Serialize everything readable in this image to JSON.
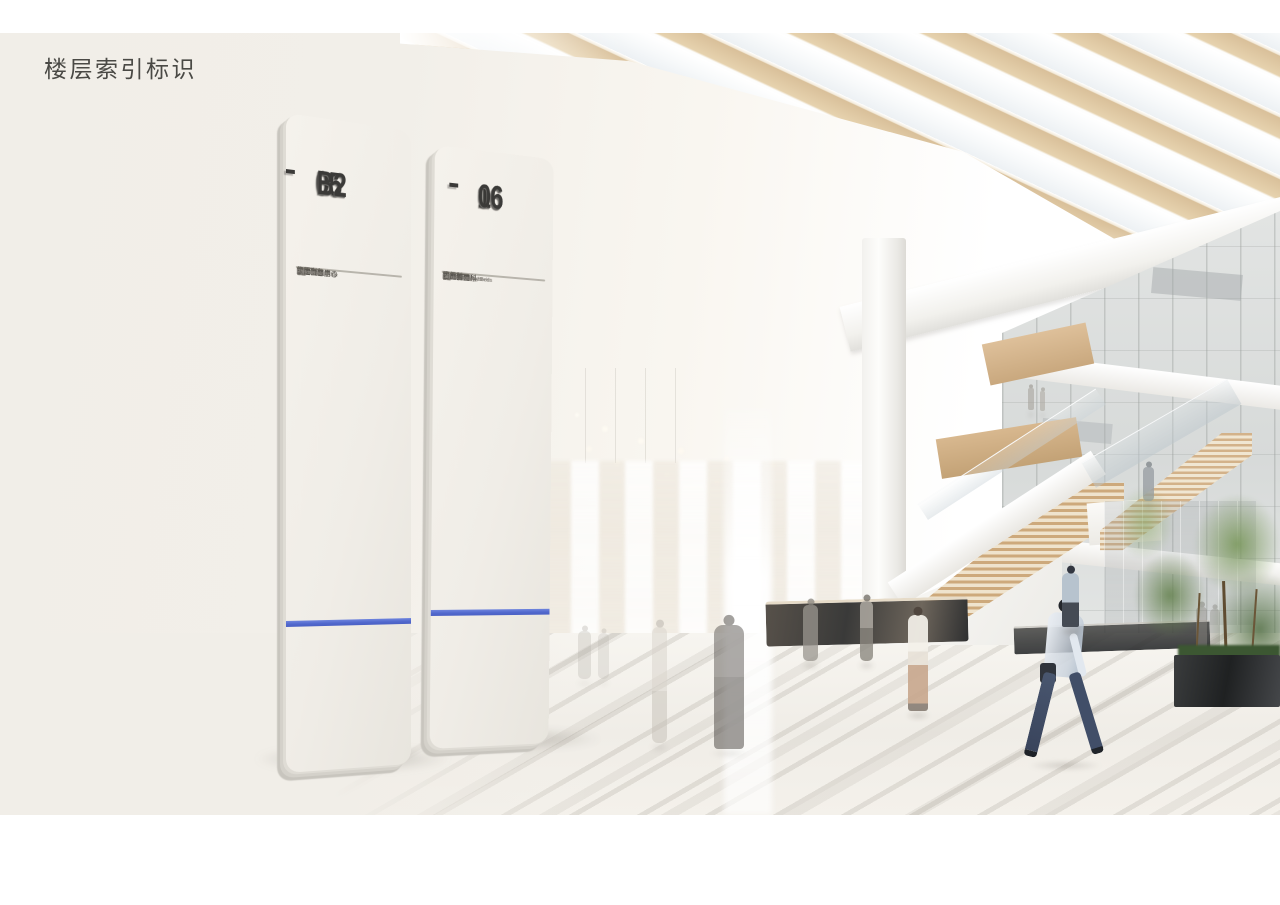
{
  "page": {
    "title": "楼层索引标识"
  },
  "colors": {
    "accent_stripe": "#5b72d2",
    "panel_face": "#f1eee8",
    "panel_edge": "#d4d1ca",
    "big_number": "#3b3a38",
    "hairline": "#7a756b",
    "text_zh": "#5a5751",
    "text_en": "#8b8780",
    "wood_beam": "#d9c09a",
    "stair_wood": "#cda97c",
    "tree_green": "#61804a",
    "background_cream": "#f1eee8"
  },
  "signs": [
    {
      "id": "sign-05-b2",
      "range_top": "05",
      "range_separator": "-",
      "range_bottom": "B2",
      "rows": [
        {
          "floor": "05",
          "zh": [
            "儿科",
            "VIP门诊",
            "行政办公",
            "生殖中心"
          ],
          "en": [
            "Peds",
            "VIP Clinic",
            "Admin",
            "Repro"
          ]
        },
        {
          "floor": "04",
          "zh": [
            "门诊",
            "产房",
            "一站式产房",
            "泌尿外科门诊",
            "检验科"
          ],
          "en": [
            "Clinic",
            "Delivery",
            "LDR",
            "Urogology",
            "Lab"
          ]
        },
        {
          "floor": "03",
          "zh": [
            "门诊",
            "手术室",
            "健康管理中心",
            "重症监护"
          ],
          "en": [
            "Clinic",
            "Surgery",
            "Health Mgmt.",
            "ICU/CCU"
          ]
        },
        {
          "floor": "02",
          "zh": [
            "门诊",
            "透析",
            "内窥镜",
            "心血管",
            "健康管理中心"
          ],
          "en": [
            "Clinic",
            "Dialysis",
            "Non-Invasive",
            "COE Cardiac",
            "Health Mgmt."
          ]
        },
        {
          "floor": "01",
          "zh": [
            "挂号中心",
            "门诊",
            "影像科",
            "药房",
            "急诊",
            "输液",
            "肿瘤",
            "化疗"
          ],
          "en": [
            "Regist",
            "Clinic",
            "RAD.",
            "Pharmacy",
            "ED.",
            "Infusion",
            "COE Onc.",
            "Chemo"
          ]
        },
        {
          "floor": "B1",
          "zh": [
            "放疗核医学",
            "车库"
          ],
          "en": [
            "Nuclear Medicine",
            "Parking"
          ]
        },
        {
          "floor": "B2",
          "zh": [
            "车库"
          ],
          "en": [
            "Parking"
          ]
        }
      ]
    },
    {
      "id": "sign-16-06",
      "range_top": "16",
      "range_separator": "-",
      "range_bottom": "06",
      "rows": [
        {
          "floor": "16",
          "zh": [
            "神经科",
            "康复"
          ],
          "en": [
            "Neurology",
            "Rehab Beds"
          ]
        },
        {
          "floor": "15",
          "zh": [
            "肾内科",
            "泌尿外科"
          ],
          "en": [
            "Nephrology",
            "Urology Beds"
          ]
        },
        {
          "floor": "14",
          "zh": [
            "呼吸内科",
            "胸外科"
          ],
          "en": [
            "Respiratory Med",
            "Thoracic Surg Beds"
          ]
        },
        {
          "floor": "13",
          "zh": [
            "眼耳鼻喉",
            "风湿免疫",
            "内分泌"
          ],
          "en": [
            "Ophthal",
            "Rheu",
            "Endo Beds"
          ]
        },
        {
          "floor": "12",
          "zh": [
            "血液",
            "肿瘤科"
          ],
          "en": [
            "Hematology",
            "Oncology"
          ]
        },
        {
          "floor": "11",
          "zh": [
            "骨科(病房)"
          ],
          "en": [
            "Ortho Beds"
          ]
        },
        {
          "floor": "10",
          "zh": [
            "普外科"
          ],
          "en": [
            "Surgery Beds"
          ]
        },
        {
          "floor": "09",
          "zh": [
            "普外科",
            "消化内科"
          ],
          "en": [
            "Surgery",
            "Gastro Beds"
          ]
        },
        {
          "floor": "08",
          "zh": [
            "心血管内科"
          ],
          "en": [
            "Cardio Medical Beds"
          ]
        },
        {
          "floor": "07",
          "zh": [
            "心血管外科"
          ],
          "en": [
            "Cardio Surgery Beds"
          ]
        },
        {
          "floor": "06",
          "zh": [
            "妇产科"
          ],
          "en": [
            "OB"
          ]
        }
      ]
    }
  ]
}
